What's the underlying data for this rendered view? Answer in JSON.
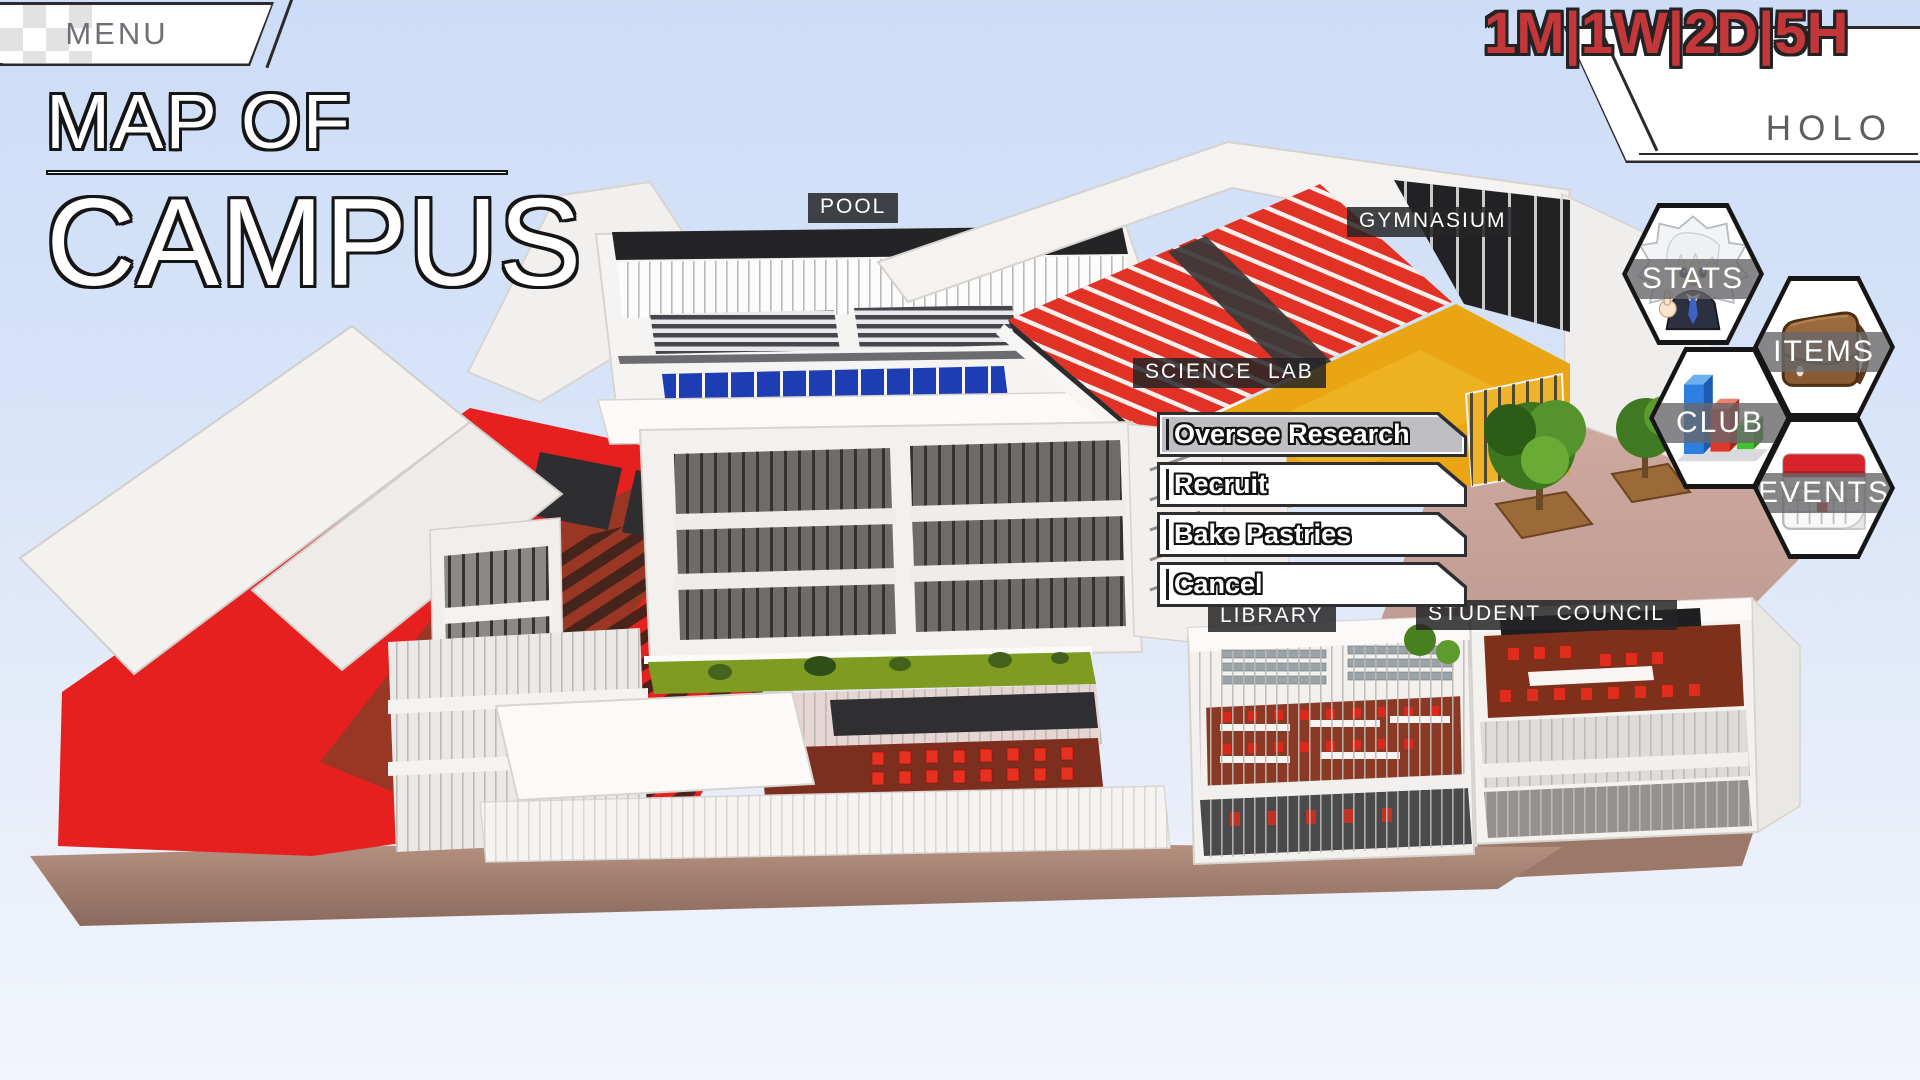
{
  "header": {
    "menu_label": "MENU",
    "time_display": "1M|1W|2D|5H",
    "holo_label": "HOLO"
  },
  "title": {
    "line1": "MAP OF",
    "line2": "CAMPUS"
  },
  "map_labels": {
    "pool": "POOL",
    "gymnasium": "GYMNASIUM",
    "science_lab": "SCIENCE  LAB",
    "library": "LIBRARY",
    "student_council": "STUDENT  COUNCIL"
  },
  "action_menu": {
    "items": [
      {
        "label": "Oversee Research",
        "selected": true
      },
      {
        "label": "Recruit",
        "selected": false
      },
      {
        "label": "Bake Pastries",
        "selected": false
      },
      {
        "label": "Cancel",
        "selected": false
      }
    ]
  },
  "nav_buttons": [
    {
      "label": "STATS",
      "icon": "character-portrait-icon"
    },
    {
      "label": "ITEMS",
      "icon": "school-bag-icon"
    },
    {
      "label": "CLUB",
      "icon": "bar-chart-icon"
    },
    {
      "label": "EVENTS",
      "icon": "calendar-icon"
    }
  ],
  "colors": {
    "timer_red": "#c33639",
    "map_red": "#e6201f",
    "gym_court_yellow": "#e9a513",
    "pool_window_blue": "#1d3db2",
    "label_bg": "rgba(37,37,39,0.85)",
    "selected_item_gray": "#bfbfc3",
    "background_top": "#cdddf7",
    "background_bottom": "#f2f5fb"
  }
}
